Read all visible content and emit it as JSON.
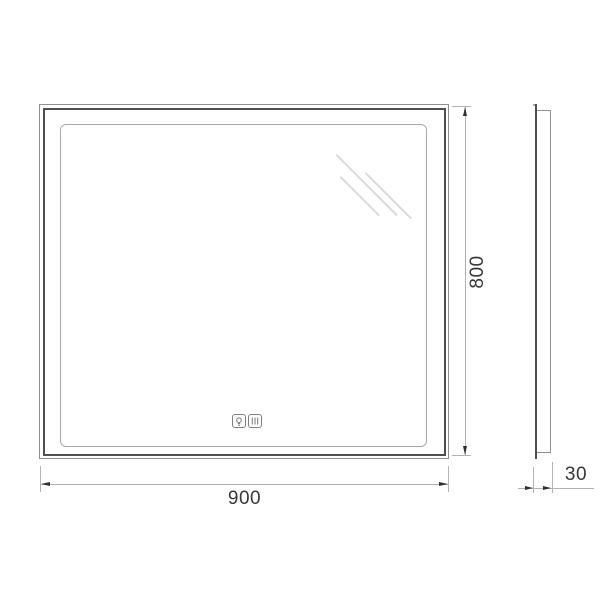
{
  "dimensions": {
    "width": "900",
    "height": "800",
    "depth": "30"
  },
  "icons": [
    {
      "name": "light-bulb-icon",
      "meaning": "touch light control"
    },
    {
      "name": "defogger-icon",
      "meaning": "anti-fog heater control"
    }
  ],
  "colors": {
    "frame_dark": "#4f4f4f",
    "frame_light": "#8f8f8f",
    "led_outline": "#a8a8a8",
    "dimension_line": "#b2b2b2",
    "arrow": "#2f2f2f",
    "dimension_text": "#383838",
    "glare": "#dadada"
  }
}
